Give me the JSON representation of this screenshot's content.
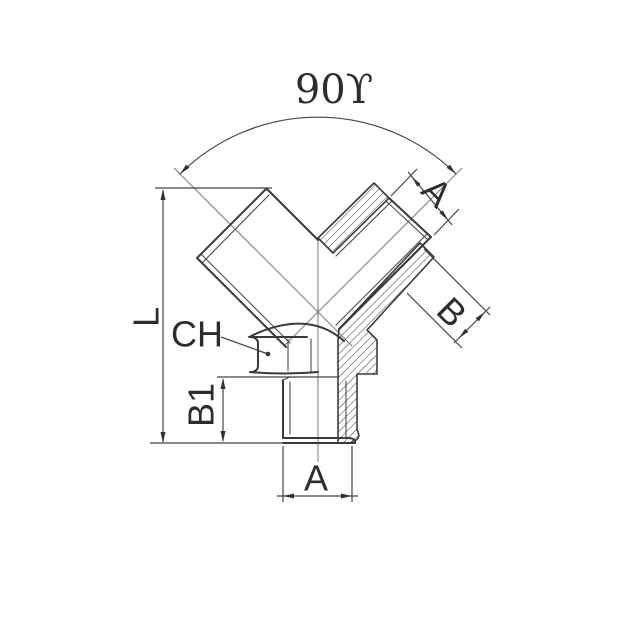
{
  "drawing": {
    "title": "90 degree Y fitting technical drawing",
    "labels": {
      "angle": "90ϒ",
      "dim_a_top": "A",
      "dim_b": "B",
      "dim_l": "L",
      "wrench": "CH",
      "dim_b1": "B1",
      "dim_a_bottom": "A"
    },
    "colors": {
      "line": "#3a3a3a",
      "dimension_line": "#444444",
      "centerline": "#7a7a7a",
      "background": "#ffffff"
    }
  }
}
